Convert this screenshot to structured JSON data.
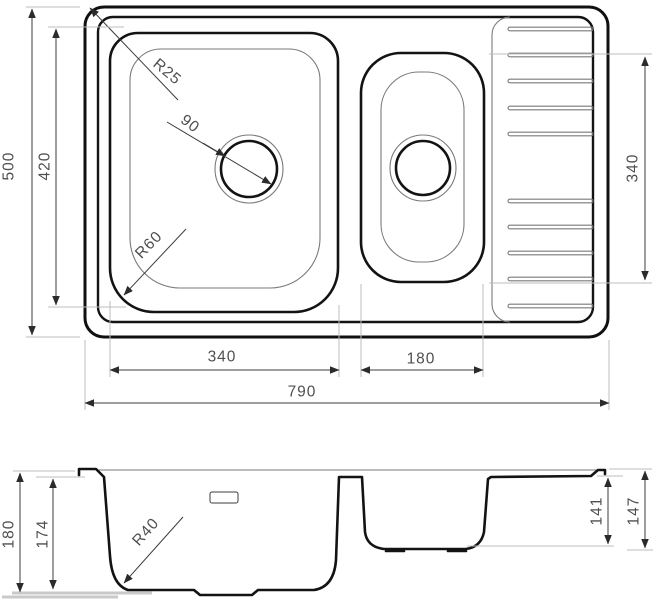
{
  "drawing_title": "sink-technical-drawing",
  "colors": {
    "background": "#ffffff",
    "line_thick": "#101010",
    "line_thin": "#7a7a7a",
    "dimension_line": "#3c3c3c",
    "extension_line": "#bdbdbd",
    "label_text": "#4f4f4f"
  },
  "top_view": {
    "overall_width": "790",
    "overall_height": "500",
    "main_bowl_width": "340",
    "main_bowl_height": "420",
    "small_bowl_width": "180",
    "drainer_span": "340",
    "drain_diameter": "90",
    "top_corner_radius": "R25",
    "bowl_corner_radius": "R60"
  },
  "section_view": {
    "overall_depth": "180",
    "main_bowl_depth": "174",
    "main_bowl_bottom_radius": "R40",
    "small_bowl_depth": "141",
    "small_bowl_overall_depth": "147"
  }
}
